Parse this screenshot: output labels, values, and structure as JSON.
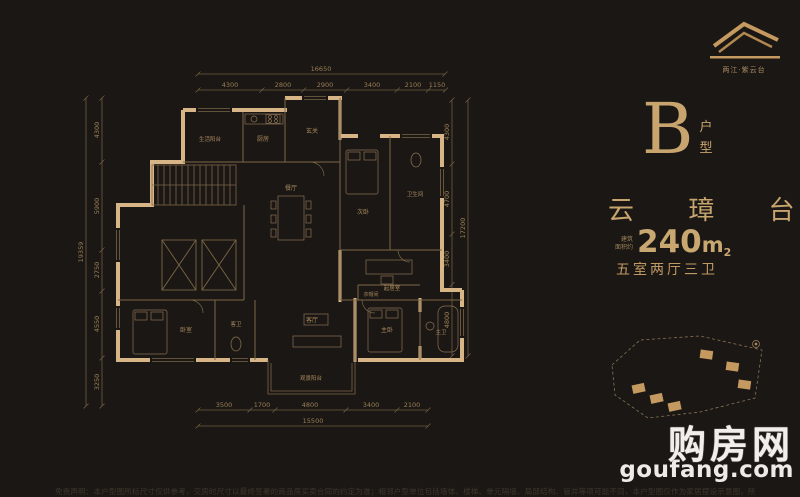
{
  "colors": {
    "background": "#1b1714",
    "gold_text": "#c8a46e",
    "wall_gold": "#d8b586",
    "thin_line": "#7c6747",
    "dim_line": "#6f5c40",
    "watermark_white": "#f1efeb"
  },
  "logo": {
    "name": "两江·紫云台"
  },
  "unit": {
    "letter": "B",
    "type_char_1": "户",
    "type_char_2": "型"
  },
  "project": {
    "name": "云 璋 台"
  },
  "area": {
    "prefix_line1": "建筑",
    "prefix_line2": "面积约",
    "value": "240",
    "unit": "m",
    "sup": "2"
  },
  "layout_summary": "五室两厅三卫",
  "dims": {
    "top": {
      "total": "16650",
      "segs": [
        "4300",
        "2800",
        "2900",
        "3400",
        "2100",
        "1150"
      ]
    },
    "bottom": {
      "total": "15500",
      "segs": [
        "3500",
        "1700",
        "4800",
        "3400",
        "2100"
      ]
    },
    "left": {
      "total": "19359",
      "segs": [
        "4300",
        "5900",
        "2750",
        "4550",
        "3250"
      ]
    },
    "right": {
      "total": "17200",
      "segs": [
        "4300",
        "4700",
        "3400",
        "4800"
      ]
    }
  },
  "plan": {
    "rooms": [
      {
        "label": "生活阳台"
      },
      {
        "label": "厨房"
      },
      {
        "label": "玄关"
      },
      {
        "label": "次卧"
      },
      {
        "label": "卫生间"
      },
      {
        "label": "餐厅"
      },
      {
        "label": "起居室"
      },
      {
        "label": "衣帽间"
      },
      {
        "label": "主卧"
      },
      {
        "label": "主卫"
      },
      {
        "label": "客厅"
      },
      {
        "label": "客卫"
      },
      {
        "label": "卧室"
      },
      {
        "label": "观景阳台"
      }
    ]
  },
  "watermark": {
    "title": "购房网",
    "domain": "goufang.com"
  },
  "disclaimer": "免责声明：本户型图所标尺寸仅供参考，交房时尺寸以最终签署的商品房买卖合同的约定为准；相邻户型单位包括墙体、楼梯、单元隔墙、局部结构、管井等项可能不同，本户型图仅作为家居摆设示意图，所示家居隔断均不作为交房标准，实际交付以合同约定为准。"
}
